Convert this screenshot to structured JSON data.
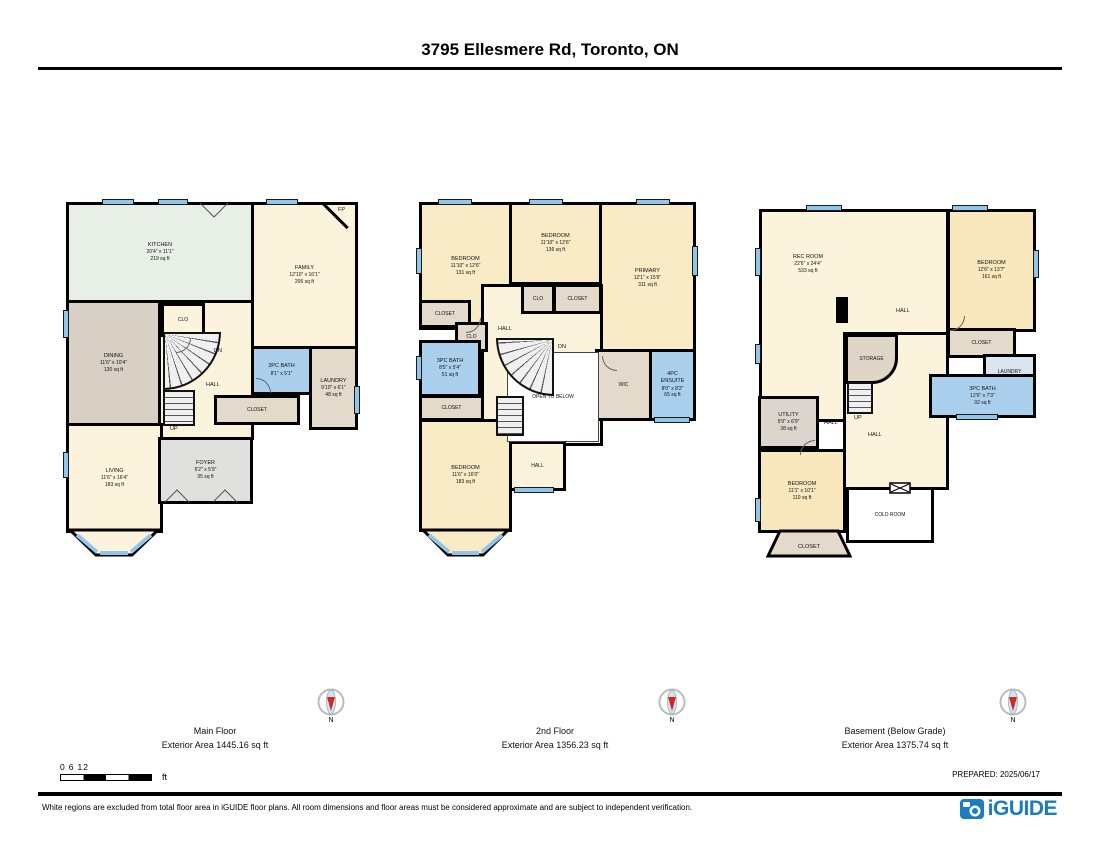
{
  "title": "3795 Ellesmere Rd, Toronto, ON",
  "prepared_label": "PREPARED: 2025/06/17",
  "compass_north": "N",
  "scale_bar": {
    "tick_0": "0",
    "tick_6": "6",
    "tick_12": "12",
    "unit": "ft"
  },
  "footer": {
    "disclaimer": "White regions are excluded from total floor area in iGUIDE floor plans. All room dimensions and floor areas must be considered approximate and are subject to independent verification.",
    "brand": "iGUIDE"
  },
  "floors": {
    "main": {
      "name": "Main Floor",
      "area": "Exterior Area 1445.16 sq ft",
      "rooms": {
        "kitchen": {
          "name": "KITCHEN",
          "dims": "20'4\" x 11'1\"",
          "area": "219 sq ft"
        },
        "family": {
          "name": "FAMILY",
          "dims": "12'10\" x 16'1\"",
          "area": "206 sq ft"
        },
        "dining": {
          "name": "DINING",
          "dims": "11'6\" x 10'4\"",
          "area": "130 sq ft"
        },
        "living": {
          "name": "LIVING",
          "dims": "11'6\" x 16'4\"",
          "area": "183 sq ft"
        },
        "foyer": {
          "name": "FOYER",
          "dims": "6'2\" x 5'9\"",
          "area": "35 sq ft"
        },
        "bath": {
          "name": "3PC BATH",
          "dims": "8'1\" x 5'1\""
        },
        "laundry": {
          "name": "LAUNDRY",
          "dims": "9'10\" x 6'1\"",
          "area": "48 sq ft"
        },
        "hall": "HALL",
        "closet": "CLOSET",
        "clo": "CLO",
        "up": "UP",
        "dn": "DN",
        "fp": "FP"
      }
    },
    "second": {
      "name": "2nd Floor",
      "area": "Exterior Area 1356.23 sq ft",
      "rooms": {
        "bedroom1": {
          "name": "BEDROOM",
          "dims": "11'10\" x 12'6\"",
          "area": "131 sq ft"
        },
        "bedroom2": {
          "name": "BEDROOM",
          "dims": "11'10\" x 12'6\"",
          "area": "136 sq ft"
        },
        "primary": {
          "name": "PRIMARY",
          "dims": "12'1\" x 15'6\"",
          "area": "311 sq ft"
        },
        "bath": {
          "name": "3PC BATH",
          "dims": "8'5\" x 5'4\"",
          "area": "51 sq ft"
        },
        "bedroom3": {
          "name": "BEDROOM",
          "dims": "11'6\" x 16'0\"",
          "area": "183 sq ft"
        },
        "ensuite": {
          "name": "4PC ENSUITE",
          "dims": "8'0\" x 8'2\"",
          "area": "65 sq ft"
        },
        "wic": "WIC",
        "open_below": "OPEN TO BELOW",
        "hall": "HALL",
        "closet": "CLOSET",
        "clo": "CLO",
        "dn": "DN"
      }
    },
    "basement": {
      "name": "Basement (Below Grade)",
      "area": "Exterior Area 1375.74 sq ft",
      "rooms": {
        "rec": {
          "name": "REC ROOM",
          "dims": "22'6\" x 24'4\"",
          "area": "533 sq ft"
        },
        "bedroom_r": {
          "name": "BEDROOM",
          "dims": "12'6\" x 13'7\"",
          "area": "161 sq ft"
        },
        "bath": {
          "name": "3PC BATH",
          "dims": "12'6\" x 7'3\"",
          "area": "92 sq ft"
        },
        "utility": {
          "name": "UTILITY",
          "dims": "5'9\" x 6'9\"",
          "area": "38 sq ft"
        },
        "bedroom_b": {
          "name": "BEDROOM",
          "dims": "11'1\" x 10'1\"",
          "area": "110 sq ft"
        },
        "laundry": "LAUNDRY",
        "storage": "STORAGE",
        "cold": "COLD ROOM",
        "hall": "HALL",
        "closet": "CLOSET",
        "up": "UP"
      }
    }
  }
}
